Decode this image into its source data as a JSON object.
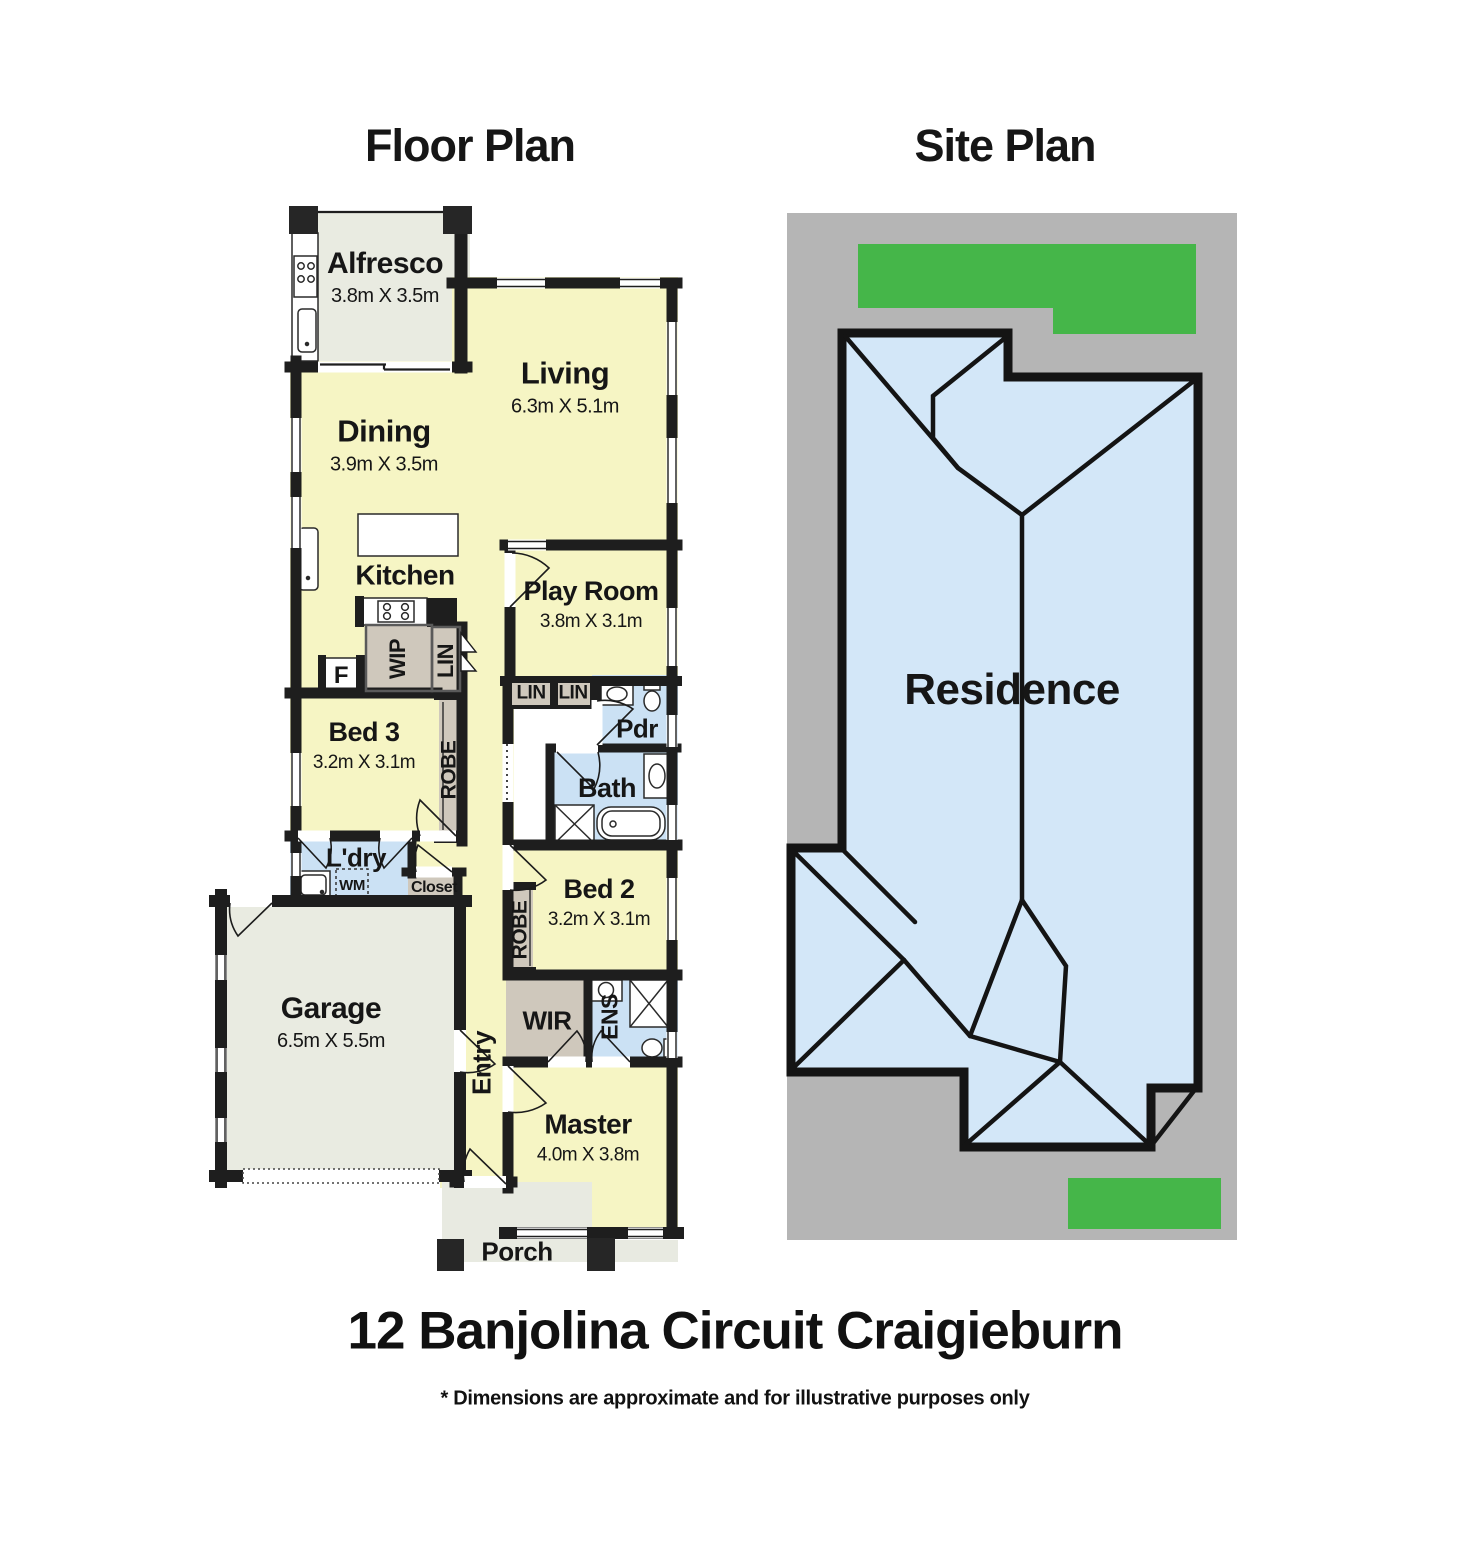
{
  "page": {
    "floor_plan_title": "Floor Plan",
    "site_plan_title": "Site Plan",
    "address": "12 Banjolina Circuit Craigieburn",
    "disclaimer": "* Dimensions are approximate and for illustrative purposes only"
  },
  "colors": {
    "room_yellow": "#f6f5c4",
    "wet_area_blue": "#cbe1f4",
    "closet_gray": "#cfc8bc",
    "garage_gray": "#e9ebe1",
    "wall_black": "#1e1e1e",
    "lot_gray": "#b5b5b5",
    "grass_green": "#45b649",
    "roof_blue": "#d3e7f8"
  },
  "floor_plan": {
    "labels": [
      {
        "id": "alfresco",
        "text": "Alfresco",
        "sub": "3.8m X 3.5m",
        "x": 385,
        "y": 277,
        "size": 30,
        "subsize": 20
      },
      {
        "id": "living",
        "text": "Living",
        "sub": "6.3m X 5.1m",
        "x": 565,
        "y": 387,
        "size": 31,
        "subsize": 20
      },
      {
        "id": "dining",
        "text": "Dining",
        "sub": "3.9m X 3.5m",
        "x": 384,
        "y": 445,
        "size": 31,
        "subsize": 20
      },
      {
        "id": "kitchen",
        "text": "Kitchen",
        "x": 405,
        "y": 576,
        "size": 28
      },
      {
        "id": "play-room",
        "text": "Play Room",
        "sub": "3.8m X 3.1m",
        "x": 591,
        "y": 605,
        "size": 27,
        "subsize": 19
      },
      {
        "id": "pdr",
        "text": "Pdr",
        "x": 637,
        "y": 729,
        "size": 26
      },
      {
        "id": "bath",
        "text": "Bath",
        "x": 607,
        "y": 789,
        "size": 27
      },
      {
        "id": "bed-3",
        "text": "Bed 3",
        "sub": "3.2m X 3.1m",
        "x": 364,
        "y": 746,
        "size": 27,
        "subsize": 19
      },
      {
        "id": "ldry",
        "text": "L'dry",
        "x": 356,
        "y": 858,
        "size": 26
      },
      {
        "id": "wm",
        "text": "WM",
        "x": 352,
        "y": 886,
        "size": 15
      },
      {
        "id": "closet",
        "text": "Closet",
        "x": 434,
        "y": 888,
        "size": 16
      },
      {
        "id": "bed-2",
        "text": "Bed 2",
        "sub": "3.2m X 3.1m",
        "x": 599,
        "y": 903,
        "size": 27,
        "subsize": 19
      },
      {
        "id": "garage",
        "text": "Garage",
        "sub": "6.5m X 5.5m",
        "x": 331,
        "y": 1022,
        "size": 30,
        "subsize": 20
      },
      {
        "id": "wir",
        "text": "WIR",
        "x": 547,
        "y": 1021,
        "size": 26
      },
      {
        "id": "master",
        "text": "Master",
        "sub": "4.0m X 3.8m",
        "x": 588,
        "y": 1138,
        "size": 28,
        "subsize": 19
      },
      {
        "id": "porch",
        "text": "Porch",
        "x": 517,
        "y": 1252,
        "size": 26
      },
      {
        "id": "f",
        "text": "F",
        "x": 341,
        "y": 676,
        "size": 24
      },
      {
        "id": "lin-a",
        "text": "LIN",
        "x": 531,
        "y": 694,
        "size": 19
      },
      {
        "id": "lin-b",
        "text": "LIN",
        "x": 573,
        "y": 694,
        "size": 19
      },
      {
        "id": "wip",
        "text": "WIP",
        "x": 398,
        "y": 659,
        "size": 22,
        "rotate": -90
      },
      {
        "id": "lin-hall",
        "text": "LIN",
        "x": 446,
        "y": 661,
        "size": 22,
        "rotate": -90
      },
      {
        "id": "robe-bed3",
        "text": "ROBE",
        "x": 449,
        "y": 770,
        "size": 21,
        "rotate": -90
      },
      {
        "id": "robe-bed2",
        "text": "ROBE",
        "x": 520,
        "y": 930,
        "size": 21,
        "rotate": -90
      },
      {
        "id": "ens",
        "text": "ENS",
        "x": 610,
        "y": 1017,
        "size": 23,
        "rotate": -90
      },
      {
        "id": "entry",
        "text": "Entry",
        "x": 482,
        "y": 1063,
        "size": 26,
        "rotate": -90
      }
    ]
  },
  "site_plan": {
    "labels": [
      {
        "id": "residence",
        "text": "Residence",
        "x": 1012,
        "y": 690,
        "size": 44
      }
    ]
  }
}
